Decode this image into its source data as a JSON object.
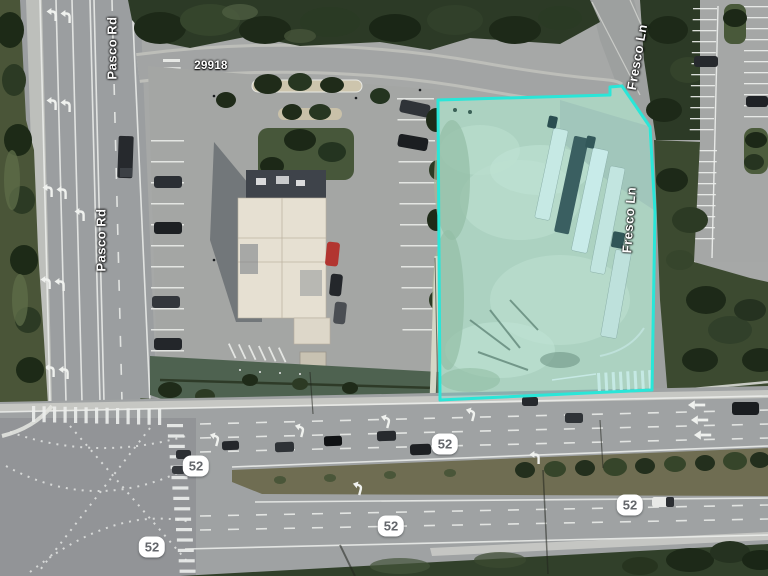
{
  "map": {
    "parcel": {
      "outline_color": "#2ae6d8",
      "fill_color": "#3ee8da",
      "fill_opacity": "0.2"
    },
    "road_labels": [
      {
        "text": "Pasco Rd"
      },
      {
        "text": "Pasco Rd"
      },
      {
        "text": "Fresco Ln"
      },
      {
        "text": "Fresco Ln"
      }
    ],
    "address_label": {
      "text": "29918"
    },
    "route_shields": [
      {
        "text": "52"
      },
      {
        "text": "52"
      },
      {
        "text": "52"
      },
      {
        "text": "52"
      },
      {
        "text": "52"
      }
    ]
  }
}
